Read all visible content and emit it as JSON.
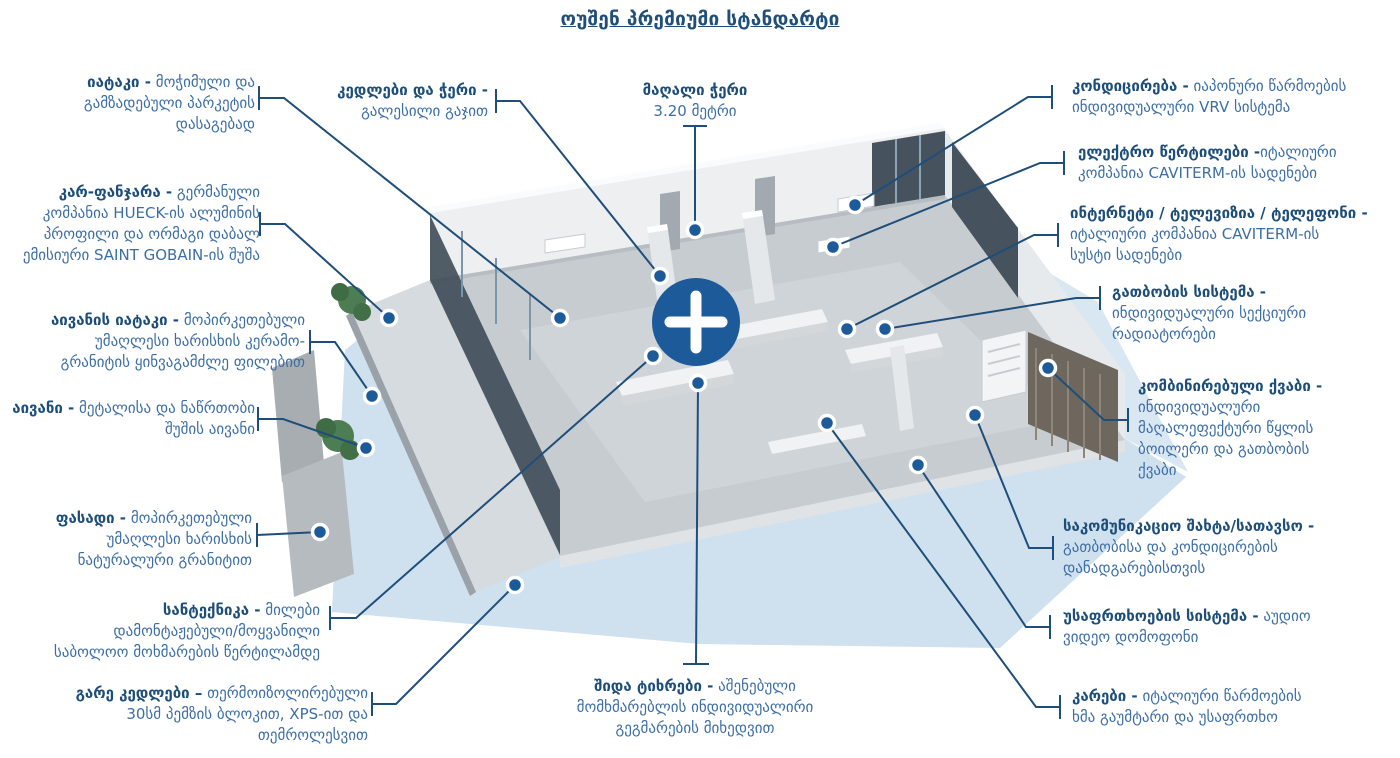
{
  "title": "ოუშენ პრემიუმი სტანდარტი",
  "colors": {
    "accent_blue": "#1c5a99",
    "bold_text": "#1d4e79",
    "body_text": "#3c6ea6",
    "leader_line": "#1e4e79",
    "shadow_blue": "#cfe0ee"
  },
  "plus_button": {
    "icon": "plus-icon"
  },
  "callouts": {
    "floor": {
      "bold": "იატაკი -",
      "rest": " მოჭიმული და\nგამზადებული პარკეტის\nდასაგებად"
    },
    "door_window": {
      "bold": "კარ-ფანჯარა -",
      "rest": " გერმანული\nკომპანია HUECK-ის ალუმინის\nპროფილი და ორმაგი დაბალ\nემისიური SAINT GOBAIN-ის შუშა"
    },
    "balcony_floor": {
      "bold": "აივანის იატაკი -",
      "rest": " მოპირკეთებული\nუმაღლესი ხარისხის კერამო-\nგრანიტის ყინვაგამძლე ფილებით"
    },
    "balcony": {
      "bold": "აივანი -",
      "rest": " მეტალისა და ნაწრთობი\nშუშის აივანი"
    },
    "facade": {
      "bold": "ფასადი -",
      "rest": " მოპირკეთებული\nუმაღლესი ხარისხის\nნატურალური გრანიტით"
    },
    "plumbing": {
      "bold": "სანტექნიკა -",
      "rest": " მილები\nდამონტაჟებული/მოყვანილი\nსაბოლოო მოხმარების წერტილამდე"
    },
    "exterior_walls": {
      "bold": "გარე კედლები –",
      "rest": " თერმოიზოლირებული\n30სმ პემზის ბლოკით, XPS-ით და\nთემროლესვით"
    },
    "walls_ceiling": {
      "bold": "კედლები და ჭერი -",
      "rest": "\nგალესილი გაჯით"
    },
    "high_ceiling": {
      "bold": "მაღალი ჭერი",
      "rest": "\n3.20 მეტრი"
    },
    "conditioning": {
      "bold": "კონდიცირება -",
      "rest": " იაპონური წარმოების\nინდივიდუალური VRV სისტემა"
    },
    "electrical_points": {
      "bold": "ელექტრო წერტილები -",
      "rest": "იტალიური\nკომპანია CAVITERM-ის სადენები"
    },
    "internet_tv_phone": {
      "bold": "ინტერნეტი / ტელევიზია / ტელეფონი -",
      "rest": "\nიტალიური კომპანია CAVITERM-ის\nსუსტი სადენები"
    },
    "heating": {
      "bold": "გათბობის სისტემა -",
      "rest": "\nინდივიდუალური სექციური\nრადიატორები"
    },
    "combi_boiler": {
      "bold": "კომბინირებული ქვაბი -",
      "rest": "\nინდივიდუალური\nმაღალეფექტური წყლის\nბოილერი და გათბობის\nქვაბი"
    },
    "utility_shaft": {
      "bold": "საკომუნიკაციო შახტა/სათავსო -",
      "rest": "\nგათბობისა და კონდიცირების\nდანადგარებისთვის"
    },
    "security": {
      "bold": "უსაფრთხოების სისტემა -",
      "rest": " აუდიო\nვიდეო დომოფონი"
    },
    "doors": {
      "bold": "კარები -",
      "rest": " იტალიური წარმოების\nხმა გაუმტარი და უსაფრთხო"
    },
    "partitions": {
      "bold": "შიდა ტიხრები -",
      "rest": " აშენებული\nმომხმარებლის ინდივიდუალირი\nგეგმარების მიხედვით"
    }
  }
}
